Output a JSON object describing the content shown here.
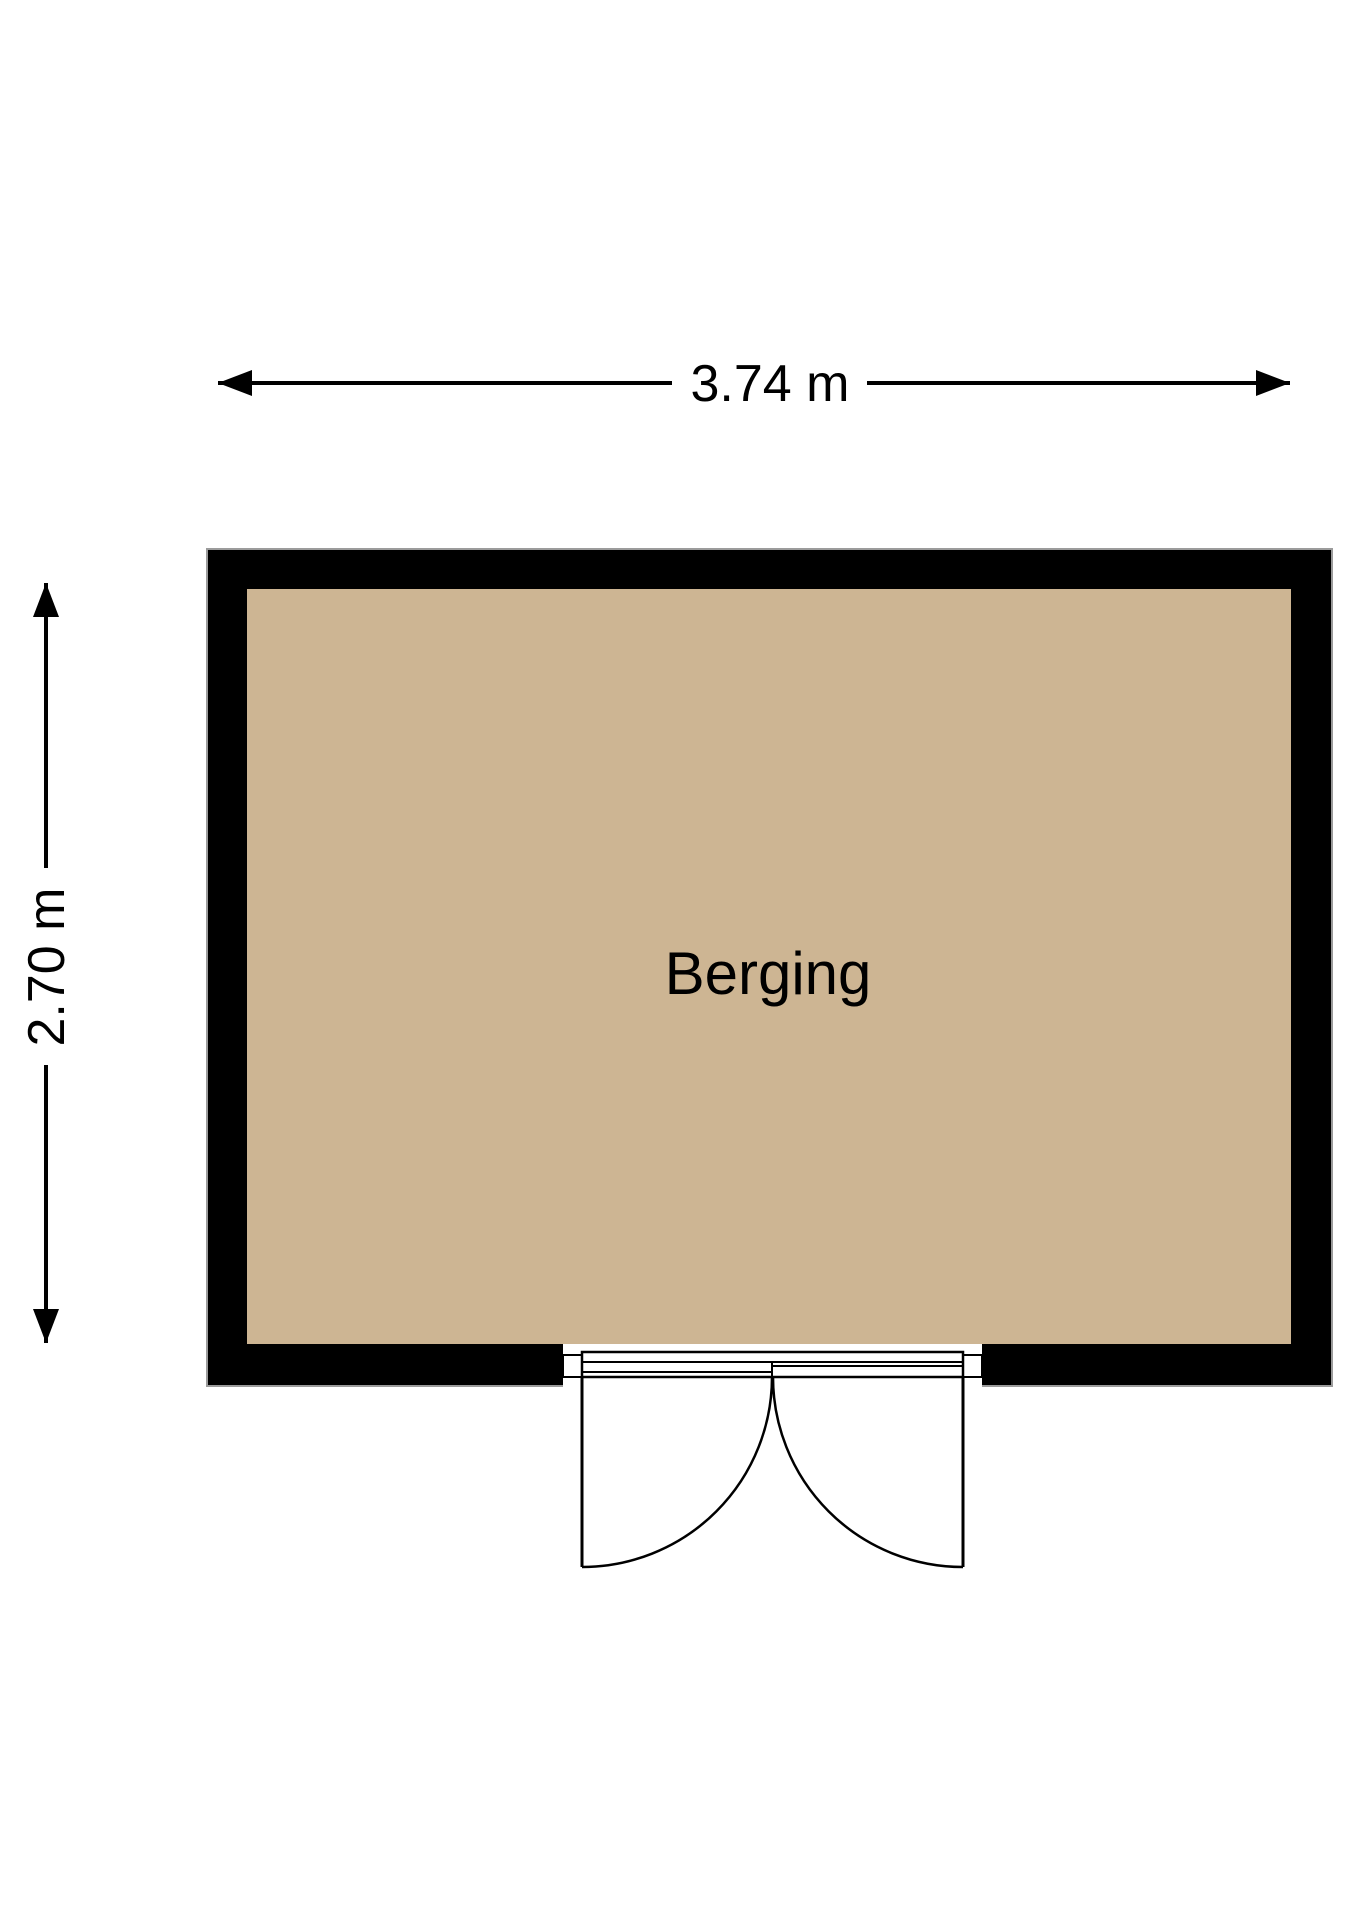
{
  "room": {
    "label": "Berging"
  },
  "dimensions": {
    "width_label": "3.74 m",
    "height_label": "2.70 m"
  },
  "door": {
    "type": "double-swing-door"
  },
  "colors": {
    "floor": "#cdb593",
    "wall": "#000000",
    "text": "#000000",
    "background": "#ffffff",
    "wall_outline": "#9b9b9b"
  }
}
